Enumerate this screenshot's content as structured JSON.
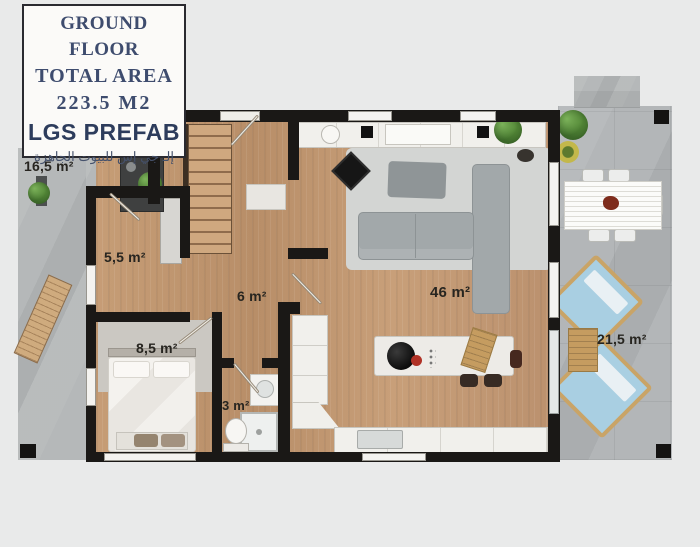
{
  "title_card": {
    "floor_label": "GROUND FLOOR",
    "total_area_label": "TOTAL AREA",
    "total_area_value": "223.5 M2",
    "brand_name": "LGS PREFAB",
    "brand_name_arabic": "إلـ جي إس للبيوت الجاهزة"
  },
  "room_labels": {
    "front_patio": "16,5 m²",
    "hall": "5,5 m²",
    "corridor": "6 m²",
    "living_kitchen": "46 m²",
    "bedroom": "8,5 m²",
    "bathroom": "3 m²",
    "terrace": "21,5 m²"
  },
  "colors": {
    "brand_navy": "#3e4c6e",
    "wall_black": "#1a1816",
    "wood_floor": "#c0976f",
    "concrete_gray": "#b5b8b9",
    "background": "#e9eaea",
    "sofa_gray": "#a2a8aa",
    "lounge_blue": "#a9cfe2"
  }
}
